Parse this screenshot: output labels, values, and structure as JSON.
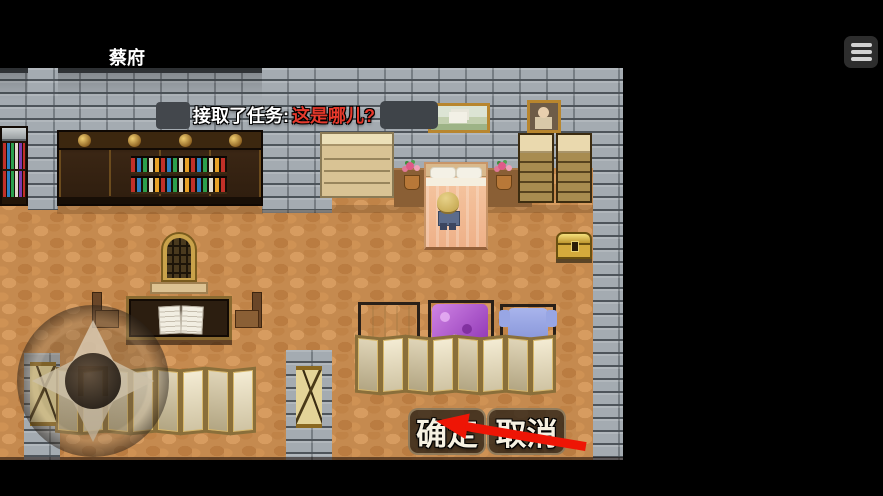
{
  "header": {
    "title": "蔡府",
    "menu_button_icon": "hamburger-icon"
  },
  "game": {
    "quest_banner": {
      "prefix": "接取了任务:",
      "quest_name": "这是哪儿?",
      "redactions": 2
    },
    "dialog": {
      "confirm_label": "确定",
      "cancel_label": "取消"
    },
    "virtual_dpad_icon": "dpad-compass-icon",
    "annotation_arrow": {
      "shape": "red-arrow",
      "points_at": "confirm-button",
      "color": "#ee1505"
    },
    "colors": {
      "quest_name_text": "#e6392c",
      "quest_prefix_text": "#ffffff",
      "floor": "#c58a4f",
      "wall_brick": "#a4abb1",
      "button_text": "#f6f1e2"
    }
  }
}
